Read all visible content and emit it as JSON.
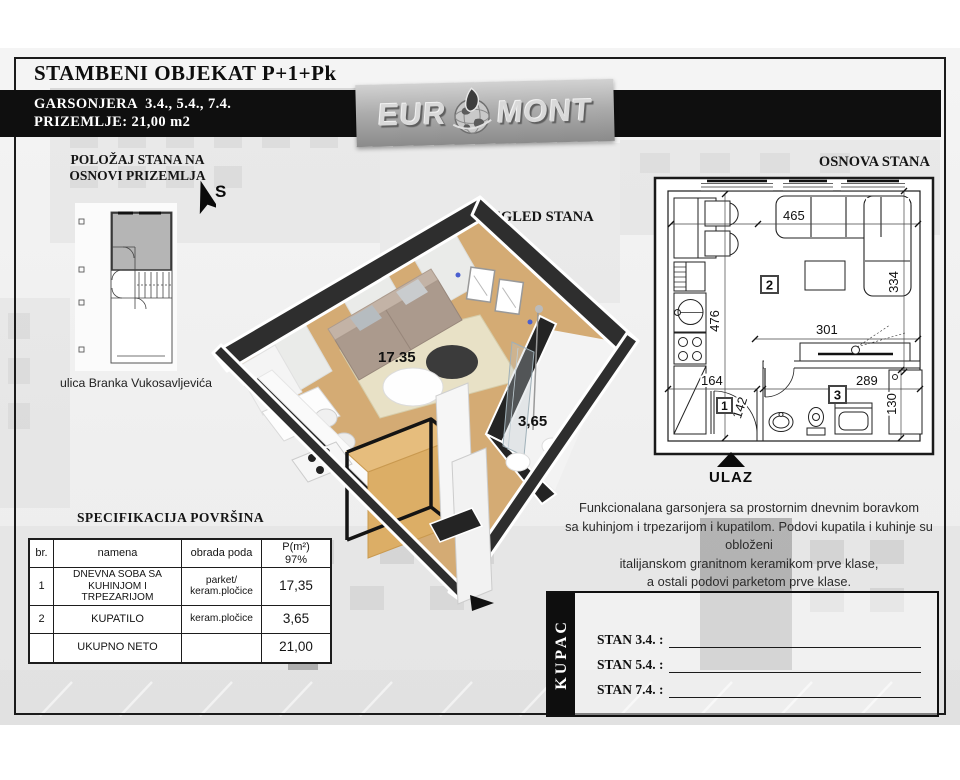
{
  "header": {
    "title": "STAMBENI OBJEKAT P+1+Pk",
    "unit_line": "GARSONJERA  3.4., 5.4., 7.4.",
    "floor_line": "PRIZEMLJE: 21,00 m2",
    "logo_left": "EUR",
    "logo_right": "MONT"
  },
  "location": {
    "title_line1": "POLOŽAJ STANA NA",
    "title_line2": "OSNOVI PRIZEMLJA",
    "compass": "S",
    "street": "ulica Branka Vukosavljevića"
  },
  "view3d": {
    "title": "3D IZGLED STANA",
    "living_area": "17.35",
    "bath_area": "3,65"
  },
  "plan": {
    "title": "OSNOVA STANA",
    "entrance_label": "ULAZ",
    "room_entrance": "1",
    "room_living": "2",
    "room_bath": "3",
    "dims": {
      "top": "465",
      "right": "334",
      "left": "476",
      "middle": "301",
      "bottom_left": "164",
      "entrance_width": "142",
      "bath_width": "289",
      "bath_right": "130"
    }
  },
  "spec": {
    "title": "SPECIFIKACIJA POVRŠINA",
    "headers": {
      "num": "br.",
      "name": "namena",
      "floor": "obrada poda",
      "area_line1": "P(m²)",
      "area_line2": "97%"
    },
    "rows": [
      {
        "num": "1",
        "name": "DNEVNA SOBA SA KUHINJOM I TRPEZARIJOM",
        "floor": "parket/ keram.pločice",
        "area": "17,35"
      },
      {
        "num": "2",
        "name": "KUPATILO",
        "floor": "keram.pločice",
        "area": "3,65"
      }
    ],
    "total": {
      "name": "UKUPNO NETO",
      "area": "21,00"
    }
  },
  "description": {
    "line1": "Funkcionalana garsonjera sa prostornim dnevnim boravkom",
    "line2": "sa kuhinjom i trpezarijom i kupatilom. Podovi kupatila i kuhinje su obloženi",
    "line3": "italijanskom granitnom keramikom prve klase,",
    "line4": "a ostali podovi parketom prve klase."
  },
  "kupac": {
    "label": "KUPAC",
    "rows": [
      {
        "label": "STAN 3.4. :"
      },
      {
        "label": "STAN 5.4. :"
      },
      {
        "label": "STAN 7.4. :"
      }
    ]
  },
  "colors": {
    "bar_black": "#0f0f0f",
    "highlight_gray": "#b5b5b5",
    "wall_dark": "#2e2e2e",
    "wood_floor": "#d4ab74"
  }
}
